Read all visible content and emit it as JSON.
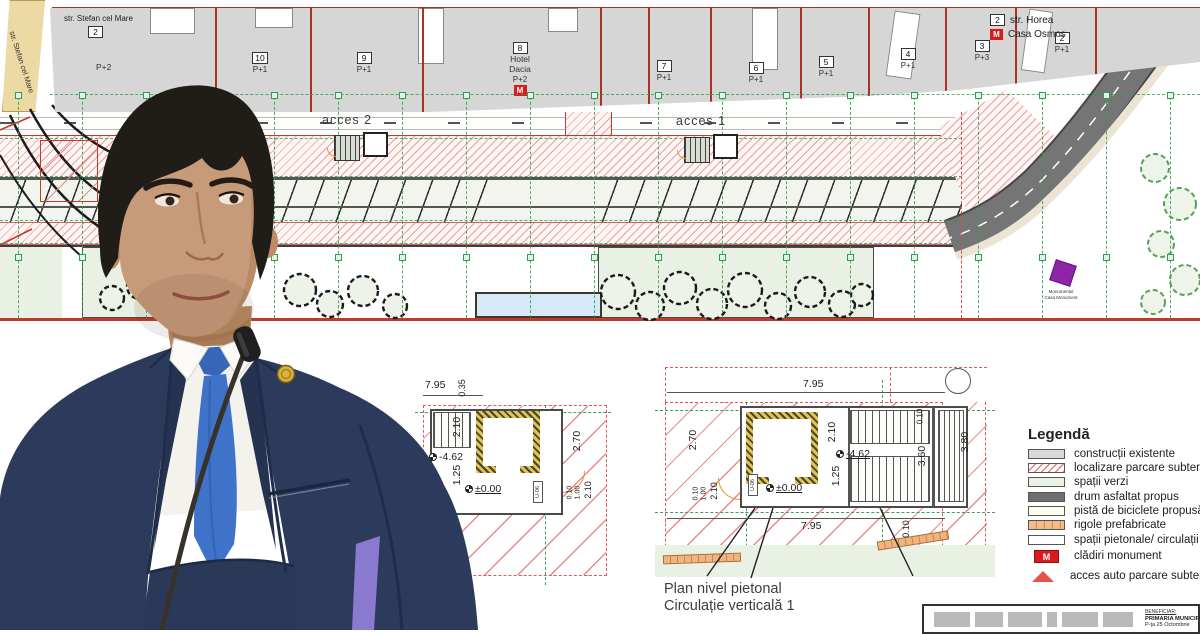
{
  "plan": {
    "top_street": {
      "label": "str. Stefan cel Mare",
      "num": "2",
      "floors": "P+2"
    },
    "diagonal_street": "str. Stefan cel Mare",
    "right_street": {
      "num": "2",
      "label": "str. Horea",
      "badge": "M",
      "badge_label": "Casa Osmos"
    },
    "acces2": "acces 2",
    "acces1": "acces 1",
    "monument": {
      "line1": "Monumentul",
      "line2": "Casa Monument"
    },
    "buildings": [
      {
        "num": "10",
        "floors": "P+1"
      },
      {
        "num": "9",
        "floors": "P+1"
      },
      {
        "num": "8",
        "name1": "Hotel",
        "name2": "Dacia",
        "floors": "P+2",
        "badge": "M"
      },
      {
        "num": "7",
        "floors": "P+1"
      },
      {
        "num": "6",
        "floors": "P+1"
      },
      {
        "num": "5",
        "floors": "P+1"
      },
      {
        "num": "4",
        "floors": "P+1"
      },
      {
        "num": "3",
        "floors": "P+3"
      },
      {
        "num": "2",
        "floors": "P+1"
      }
    ]
  },
  "details": {
    "left": {
      "d_795": "7.95",
      "d_035": "0.35",
      "d_210a": "2.10",
      "d_462": "-4.62",
      "d_125": "1.25",
      "d_000": "±0.00",
      "d_270": "2.70",
      "d_010": "0.10",
      "d_100": "1.00",
      "d_210b": "2.10",
      "unit": "U-06"
    },
    "right": {
      "d_795_top": "7.95",
      "d_270": "2.70",
      "d_010a": "0.10",
      "d_100": "1.00",
      "d_210a": "2.10",
      "d_210b": "2.10",
      "d_462": "-4.62",
      "d_125": "1.25",
      "d_000": "±0.00",
      "d_360": "3.60",
      "d_010b": "0.10",
      "d_380": "3.80",
      "d_795_bottom": "7.95",
      "d_010c": "0.10",
      "unit": "U-06"
    },
    "caption1": "Plan nivel pietonal",
    "caption2": "Circulație verticală 1"
  },
  "legend": {
    "title": "Legendă",
    "items": [
      {
        "swatch": "existing",
        "label": "construcții existente"
      },
      {
        "swatch": "hatch",
        "label": "localizare parcare subterană"
      },
      {
        "swatch": "green",
        "label": "spații verzi"
      },
      {
        "swatch": "road",
        "label": "drum asfaltat propus"
      },
      {
        "swatch": "bike",
        "label": "pistă de biciclete propusă"
      },
      {
        "swatch": "rigole",
        "label": "rigole prefabricate"
      },
      {
        "swatch": "pedestrian",
        "label": "spații pietonale/ circulații auto"
      },
      {
        "swatch": "monument",
        "badge": "M",
        "label": "clădiri monument"
      },
      {
        "swatch": "triangle",
        "label": "acces auto parcare subterană"
      }
    ]
  },
  "title_block": {
    "beneficiar": "BENEFICIAR:",
    "name": "PRIMARIA MUNICIP",
    "address": "P-ța 25 Octombrie"
  },
  "colors": {
    "accent_red": "#c0392b",
    "hatch_red": "#eb9e9e",
    "green_grid": "#2f9e4f",
    "green_space": "#e9f0e4",
    "road_dark": "#757575",
    "tan": "#ecd9a4",
    "monument_purple": "#8e24aa",
    "badge_red": "#d81b1b",
    "suit_navy": "#2c3a5c",
    "tie_blue": "#3f73c9"
  }
}
